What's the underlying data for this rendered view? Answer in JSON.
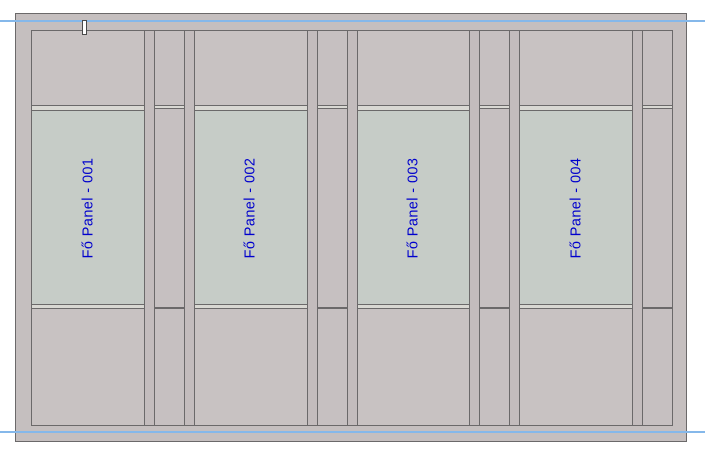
{
  "view": {
    "colors": {
      "frame_color": "#c5bfbf",
      "section_color": "#c8c2c2",
      "mullion_color": "#c3bcbd",
      "narrow_color": "#c6c0c1",
      "glass_color": "#c6ccc7",
      "band_color": "#d9d8d3",
      "line_color": "#6b696a",
      "ref_line_color": "#85b8ea",
      "label_color": "#0000cd"
    }
  },
  "panels": [
    {
      "label": "Fő Panel - 001"
    },
    {
      "label": "Fő Panel - 002"
    },
    {
      "label": "Fő Panel - 003"
    },
    {
      "label": "Fő Panel - 004"
    }
  ]
}
